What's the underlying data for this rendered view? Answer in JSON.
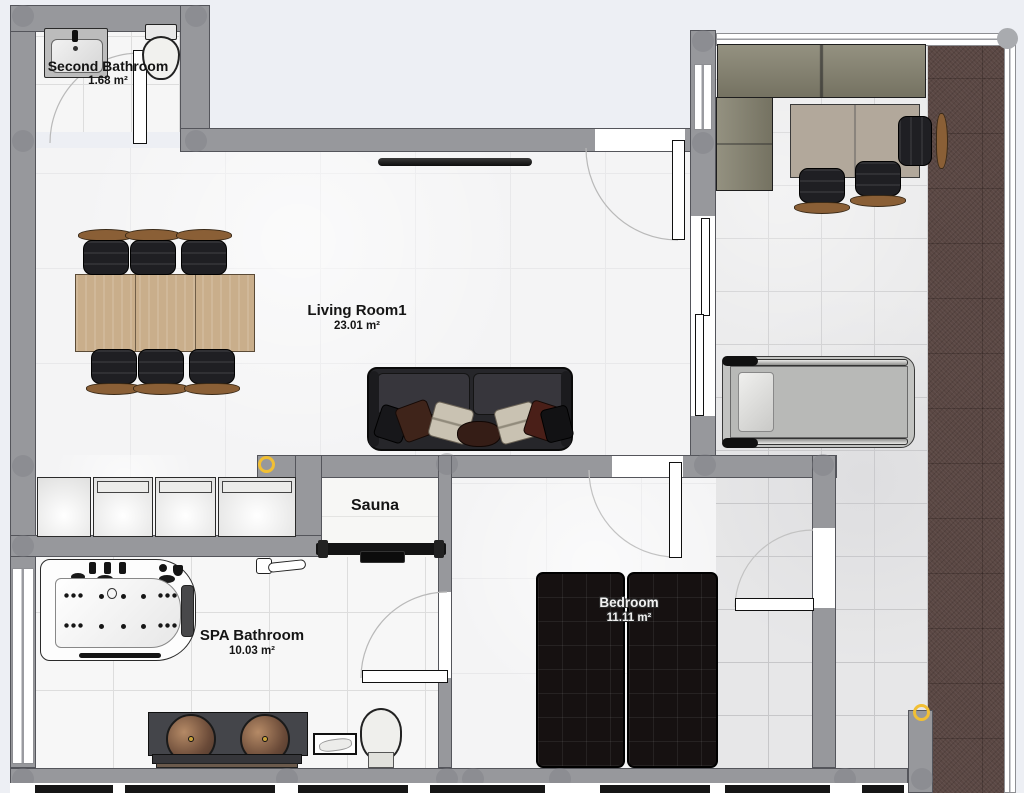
{
  "plan": {
    "type": "apartment-floor-plan",
    "background": "#edeff4"
  },
  "rooms": [
    {
      "name": "Second Bathroom",
      "area": "1.68 m²"
    },
    {
      "name": "Living Room1",
      "area": "23.01 m²"
    },
    {
      "name": "Sauna",
      "area": ""
    },
    {
      "name": "SPA Bathroom",
      "area": "10.03 m²"
    },
    {
      "name": "Bedroom",
      "area": "11.11 m²"
    }
  ],
  "colors": {
    "wall": "#97989c",
    "marker_ring": "#f1bf34",
    "corner_handle": "#a9abaf",
    "terrace_floor": "#5a4743",
    "bed": "#161111",
    "table_wood": "#c9ae8b",
    "sofa": "#26262a",
    "office_sofa": "#85826f",
    "copper_sink": "#8a6248"
  },
  "markers": {
    "yellow_rings": 2,
    "corner_handles": 1
  }
}
